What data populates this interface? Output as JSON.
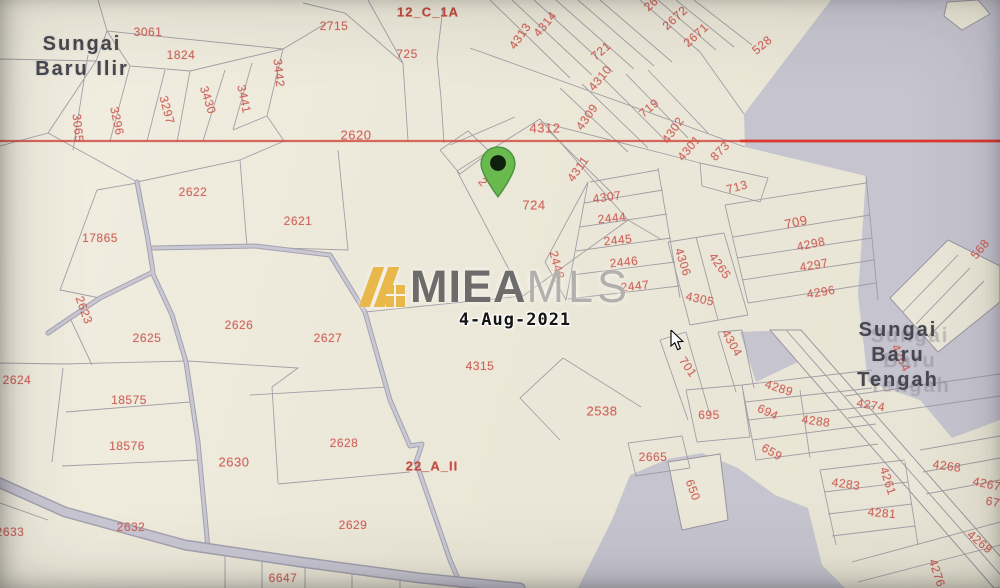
{
  "watermark": {
    "brand_bold": "MIEA",
    "brand_light": "MLS",
    "date": "4-Aug-2021"
  },
  "map": {
    "colors": {
      "background": "#ece8d9",
      "water_gray": "#c6c4cf",
      "parcel_line": "#9a97a1",
      "parcel_number_red": "#cc5b52",
      "boundary_red_line": "#d0473f",
      "road_fill": "#c9c7d3",
      "place_name_gray": "#47474f",
      "pin_green": "#69b94f",
      "watermark_gold": "#e8b84a"
    },
    "place_names": [
      {
        "lines": [
          "Sungai",
          "Baru Ilir"
        ],
        "x": 82,
        "y": 44,
        "ghost": false
      },
      {
        "lines": [
          "Sungai",
          "Baru",
          "Tengah"
        ],
        "x": 898,
        "y": 330,
        "ghost": true
      }
    ],
    "zone_labels": [
      {
        "t": "12_C_1A",
        "x": 428,
        "y": 12
      },
      {
        "t": "22_A_II",
        "x": 432,
        "y": 466
      }
    ],
    "parcels": [
      {
        "t": "3061",
        "x": 148,
        "y": 32
      },
      {
        "t": "1824",
        "x": 181,
        "y": 55
      },
      {
        "t": "3065",
        "x": 78,
        "y": 128,
        "r": 84
      },
      {
        "t": "3296",
        "x": 117,
        "y": 121,
        "r": 78
      },
      {
        "t": "3297",
        "x": 167,
        "y": 110,
        "r": 75
      },
      {
        "t": "3430",
        "x": 208,
        "y": 100,
        "r": 72
      },
      {
        "t": "3441",
        "x": 244,
        "y": 99,
        "r": 78
      },
      {
        "t": "3442",
        "x": 279,
        "y": 73,
        "r": 84
      },
      {
        "t": "2715",
        "x": 334,
        "y": 26
      },
      {
        "t": "725",
        "x": 407,
        "y": 54
      },
      {
        "t": "2620",
        "x": 356,
        "y": 135,
        "s": 13
      },
      {
        "t": "2621",
        "x": 298,
        "y": 221
      },
      {
        "t": "2622",
        "x": 193,
        "y": 192
      },
      {
        "t": "17865",
        "x": 100,
        "y": 238
      },
      {
        "t": "2623",
        "x": 84,
        "y": 310,
        "r": 70
      },
      {
        "t": "2625",
        "x": 147,
        "y": 338
      },
      {
        "t": "2626",
        "x": 239,
        "y": 325
      },
      {
        "t": "2627",
        "x": 328,
        "y": 338
      },
      {
        "t": "2624",
        "x": 17,
        "y": 380
      },
      {
        "t": "18575",
        "x": 129,
        "y": 400
      },
      {
        "t": "18576",
        "x": 127,
        "y": 446
      },
      {
        "t": "2630",
        "x": 234,
        "y": 462,
        "s": 13
      },
      {
        "t": "2632",
        "x": 131,
        "y": 527
      },
      {
        "t": "2633",
        "x": 10,
        "y": 532
      },
      {
        "t": "2629",
        "x": 353,
        "y": 525
      },
      {
        "t": "6647",
        "x": 283,
        "y": 578
      },
      {
        "t": "2628",
        "x": 344,
        "y": 443
      },
      {
        "t": "4315",
        "x": 480,
        "y": 366
      },
      {
        "t": "2",
        "x": 483,
        "y": 182,
        "r": 50
      },
      {
        "t": "724",
        "x": 534,
        "y": 205,
        "s": 13
      },
      {
        "t": "4312",
        "x": 545,
        "y": 128,
        "s": 13
      },
      {
        "t": "4313",
        "x": 520,
        "y": 36,
        "r": -55
      },
      {
        "t": "4314",
        "x": 545,
        "y": 24,
        "r": -50
      },
      {
        "t": "721",
        "x": 601,
        "y": 51,
        "r": -40
      },
      {
        "t": "4310",
        "x": 600,
        "y": 78,
        "r": -50
      },
      {
        "t": "4309",
        "x": 587,
        "y": 117,
        "r": -55
      },
      {
        "t": "4311",
        "x": 578,
        "y": 169,
        "r": -55
      },
      {
        "t": "26",
        "x": 651,
        "y": 4,
        "r": -42
      },
      {
        "t": "2672",
        "x": 675,
        "y": 18,
        "r": -42
      },
      {
        "t": "2671",
        "x": 696,
        "y": 35,
        "r": -42
      },
      {
        "t": "528",
        "x": 762,
        "y": 45,
        "r": -40
      },
      {
        "t": "719",
        "x": 649,
        "y": 108,
        "r": -40
      },
      {
        "t": "4302",
        "x": 673,
        "y": 130,
        "r": -55
      },
      {
        "t": "4301",
        "x": 689,
        "y": 148,
        "r": -50
      },
      {
        "t": "873",
        "x": 720,
        "y": 151,
        "r": -45
      },
      {
        "t": "713",
        "x": 737,
        "y": 187,
        "r": -15
      },
      {
        "t": "709",
        "x": 796,
        "y": 222,
        "r": -12,
        "s": 13
      },
      {
        "t": "4298",
        "x": 811,
        "y": 244,
        "r": -12
      },
      {
        "t": "4297",
        "x": 814,
        "y": 265,
        "r": -10
      },
      {
        "t": "4296",
        "x": 821,
        "y": 292,
        "r": -10
      },
      {
        "t": "568",
        "x": 980,
        "y": 249,
        "r": -50
      },
      {
        "t": "4306",
        "x": 683,
        "y": 262,
        "r": 72
      },
      {
        "t": "4265",
        "x": 720,
        "y": 266,
        "r": 55
      },
      {
        "t": "4305",
        "x": 700,
        "y": 299,
        "r": 12
      },
      {
        "t": "4304",
        "x": 732,
        "y": 343,
        "r": 60
      },
      {
        "t": "4307",
        "x": 607,
        "y": 197,
        "r": -8
      },
      {
        "t": "2444",
        "x": 612,
        "y": 218,
        "r": -6
      },
      {
        "t": "2445",
        "x": 618,
        "y": 240,
        "r": -6
      },
      {
        "t": "2446",
        "x": 624,
        "y": 262,
        "r": -6
      },
      {
        "t": "2447",
        "x": 635,
        "y": 286,
        "r": -6
      },
      {
        "t": "2448",
        "x": 557,
        "y": 265,
        "r": 75
      },
      {
        "t": "2538",
        "x": 602,
        "y": 411,
        "s": 13
      },
      {
        "t": "701",
        "x": 688,
        "y": 367,
        "r": 55
      },
      {
        "t": "695",
        "x": 709,
        "y": 415
      },
      {
        "t": "2665",
        "x": 653,
        "y": 457
      },
      {
        "t": "650",
        "x": 693,
        "y": 490,
        "r": 70
      },
      {
        "t": "4289",
        "x": 779,
        "y": 388,
        "r": 18
      },
      {
        "t": "694",
        "x": 768,
        "y": 412,
        "r": 25
      },
      {
        "t": "659",
        "x": 772,
        "y": 452,
        "r": 30
      },
      {
        "t": "4274",
        "x": 871,
        "y": 405,
        "r": 10
      },
      {
        "t": "4288",
        "x": 816,
        "y": 421,
        "r": 8
      },
      {
        "t": "4264",
        "x": 901,
        "y": 358,
        "r": 65
      },
      {
        "t": "4268",
        "x": 947,
        "y": 466,
        "r": 8
      },
      {
        "t": "4267",
        "x": 987,
        "y": 484,
        "r": 12
      },
      {
        "t": "4283",
        "x": 846,
        "y": 484,
        "r": 8
      },
      {
        "t": "4261",
        "x": 888,
        "y": 481,
        "r": 72
      },
      {
        "t": "4281",
        "x": 882,
        "y": 513,
        "r": 5
      },
      {
        "t": "67",
        "x": 993,
        "y": 502,
        "r": 12
      },
      {
        "t": "4269",
        "x": 980,
        "y": 542,
        "r": 40
      },
      {
        "t": "4276",
        "x": 937,
        "y": 573,
        "r": 72
      }
    ]
  }
}
